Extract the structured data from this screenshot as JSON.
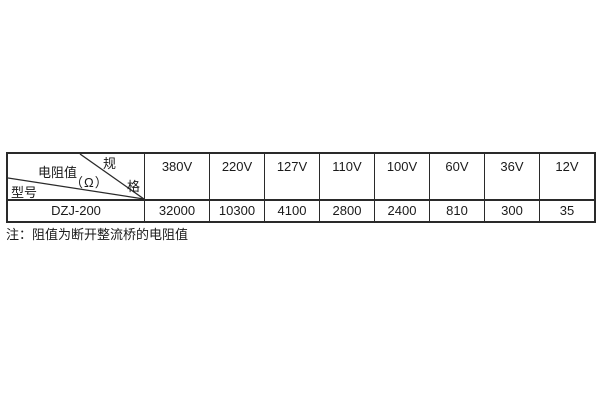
{
  "table": {
    "corner": {
      "spec_char_top": "规",
      "spec_char_bottom": "格",
      "resistance_label": "电阻值",
      "resistance_unit": "（Ω）",
      "model_label": "型号"
    },
    "columns": [
      "380V",
      "220V",
      "127V",
      "110V",
      "100V",
      "60V",
      "36V",
      "12V"
    ],
    "model": "DZJ-200",
    "values": [
      "32000",
      "10300",
      "4100",
      "2800",
      "2400",
      "810",
      "300",
      "35"
    ]
  },
  "note": {
    "text": "注：阻值为断开整流桥的电阻值"
  },
  "colors": {
    "border": "#2a2a2a",
    "text": "#1a1a1a",
    "background": "#ffffff"
  }
}
